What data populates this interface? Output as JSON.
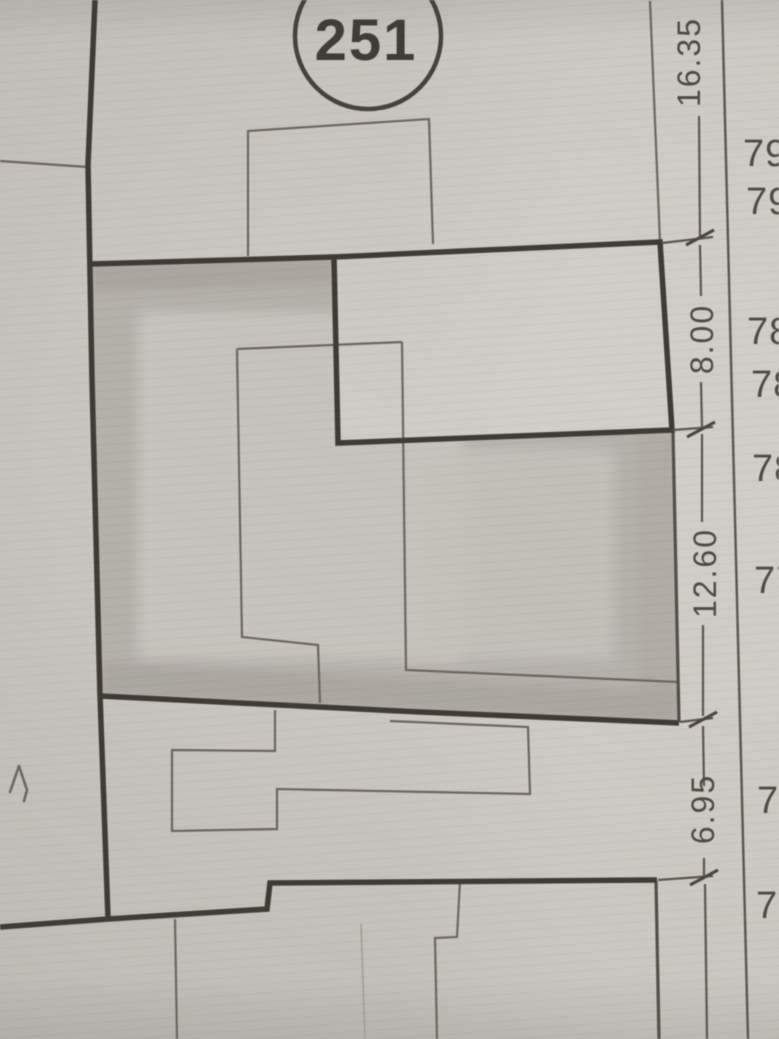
{
  "plan": {
    "parcel_number": "251",
    "dimensions": [
      "16.35",
      "8.00",
      "12.60",
      "6.95"
    ],
    "elevations": [
      "79",
      "79",
      "78",
      "78",
      "78",
      "77",
      "77",
      "77"
    ],
    "handwritten_mark": "1"
  }
}
